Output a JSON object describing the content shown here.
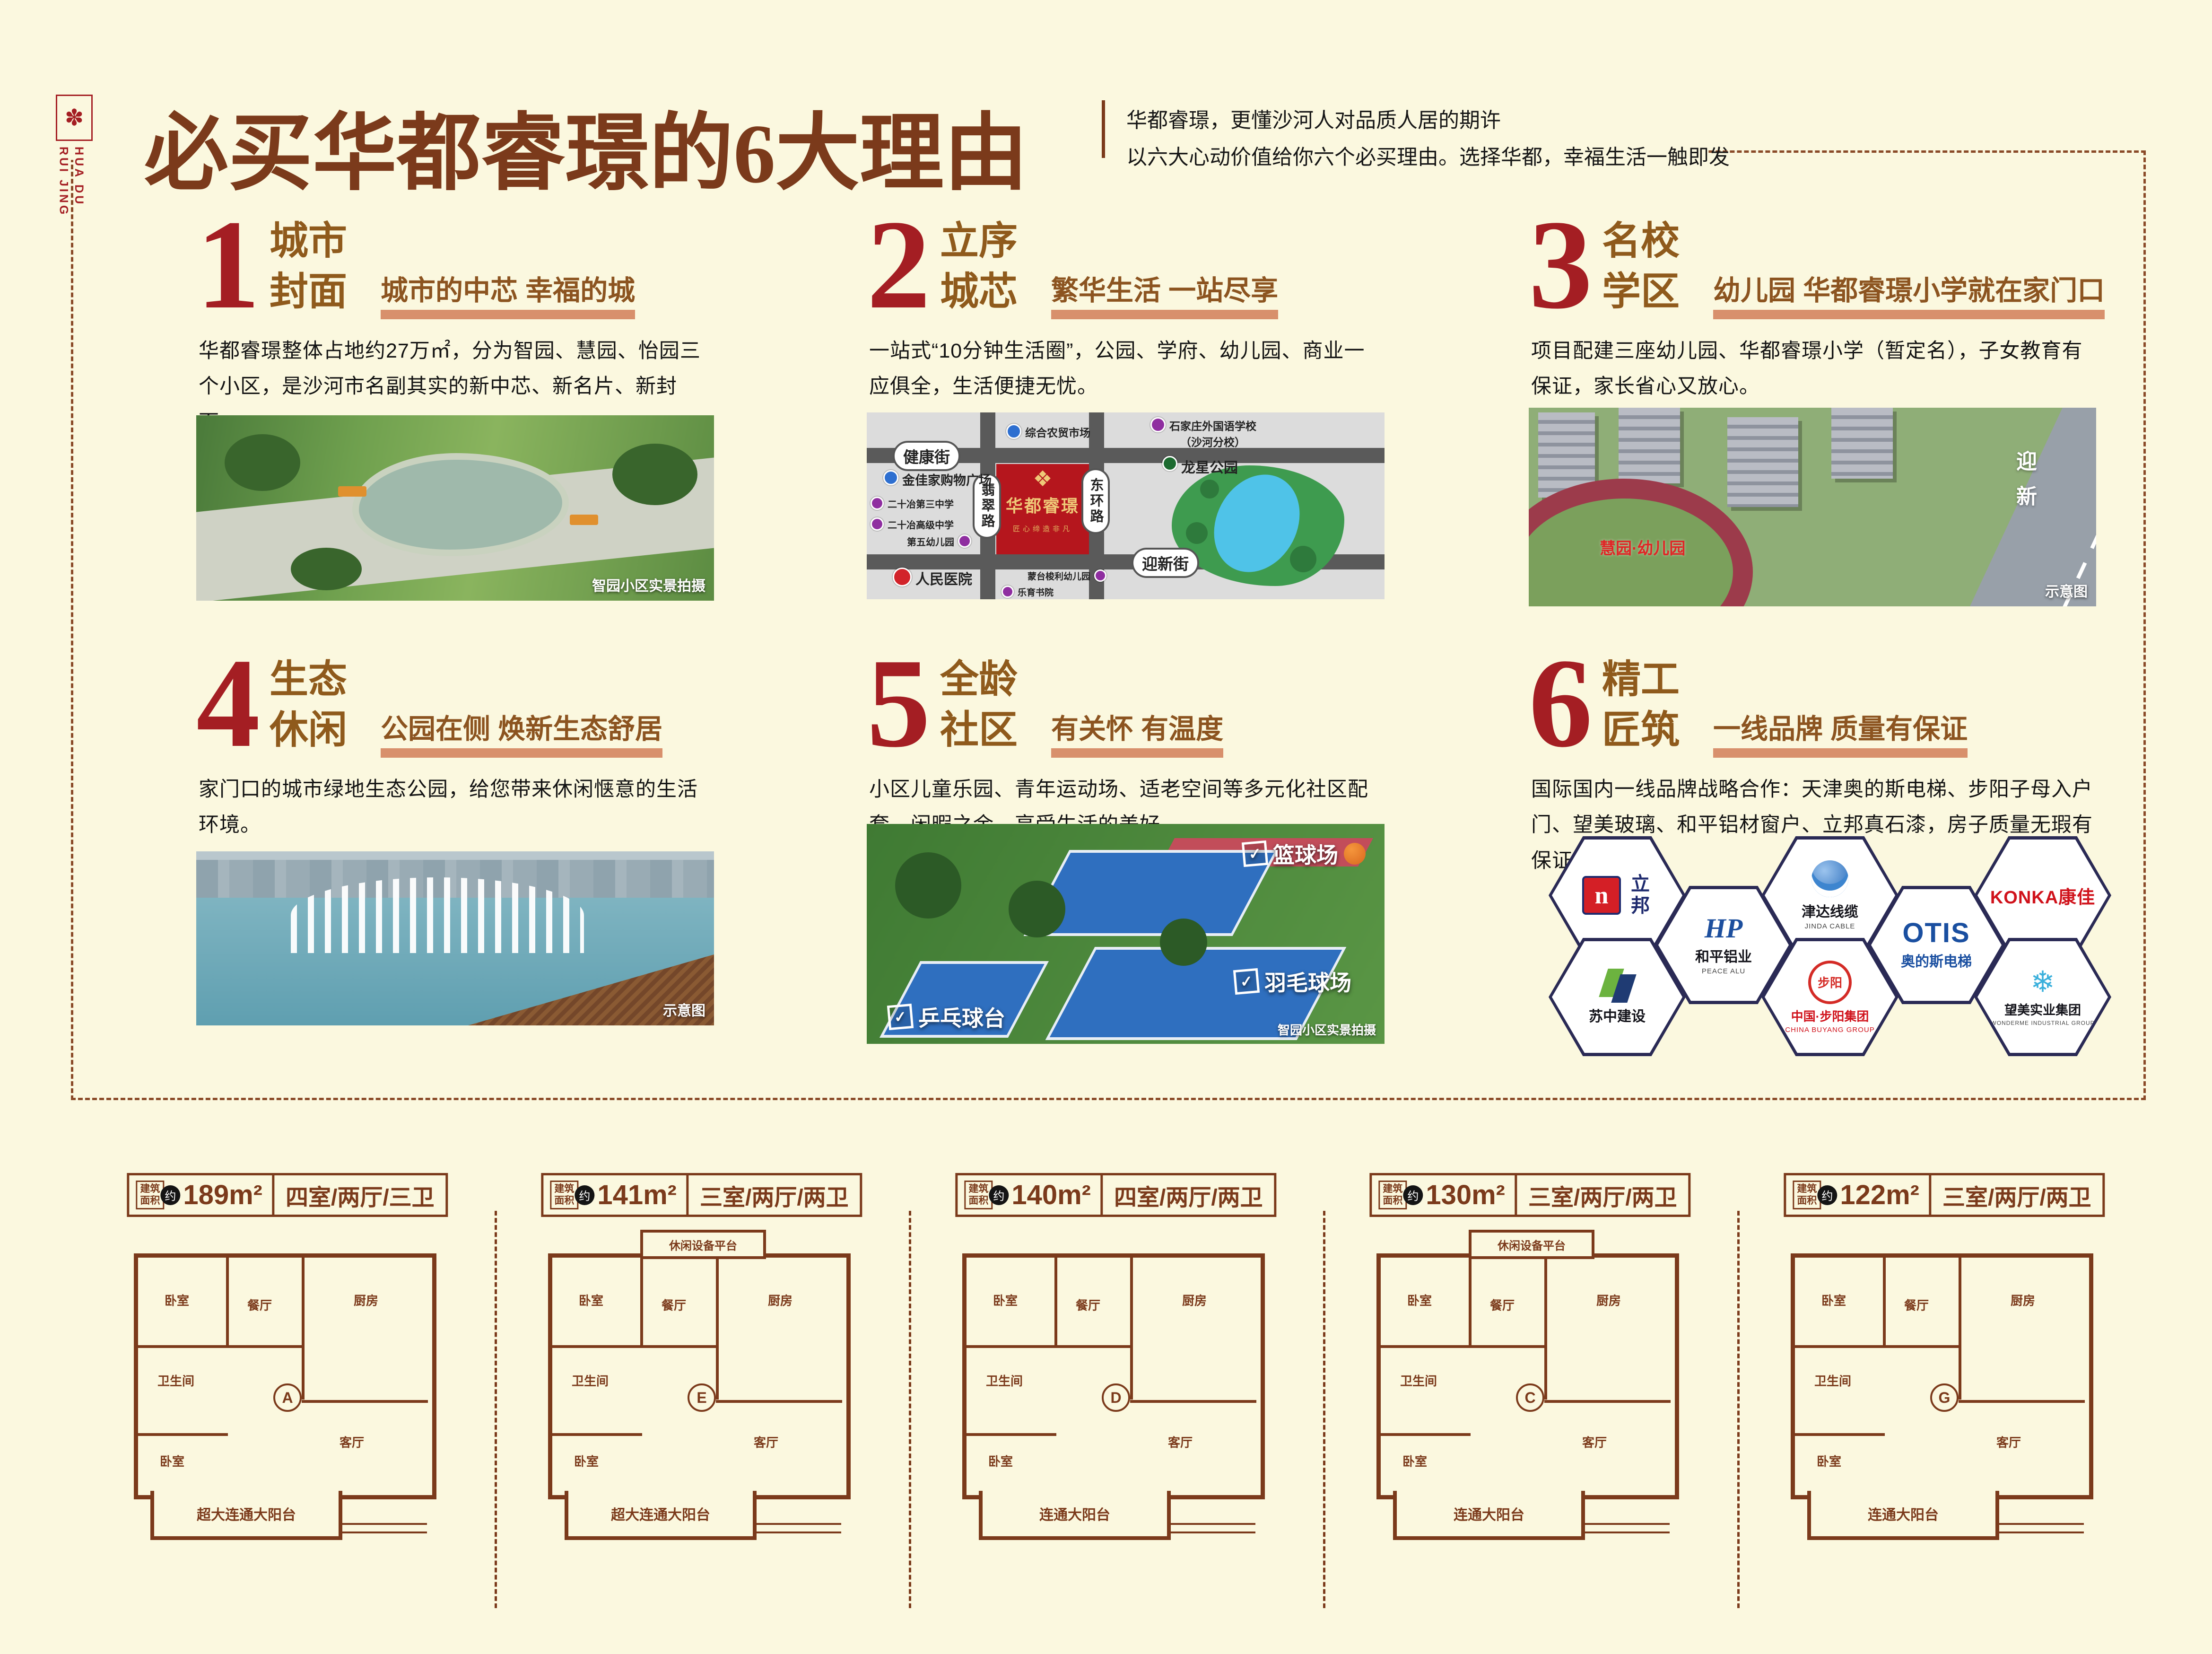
{
  "palette": {
    "background": "#FBF8DF",
    "title_brown": "#7B3A1B",
    "number_red": "#A41E23",
    "heading_tan": "#8F5A1C",
    "underline_salmon": "#D8906C",
    "map_project_red": "#B5161D",
    "map_gold": "#EFC978"
  },
  "logo": {
    "vertical_text": "HUA DU\nRUI JING"
  },
  "header": {
    "title": "必买华都睿璟的6大理由",
    "subtitle_line1": "华都睿璟，更懂沙河人对品质人居的期许",
    "subtitle_line2": "以六大心动价值给你六个必买理由。选择华都，幸福生活一触即发"
  },
  "sections": [
    {
      "number": "1",
      "title_line1": "城市",
      "title_line2": "封面",
      "tagline": "城市的中芯 幸福的城",
      "body": "华都睿璟整体占地约27万㎡，分为智园、慧园、怡园三个小区，是沙河市名副其实的新中芯、新名片、新封面。"
    },
    {
      "number": "2",
      "title_line1": "立序",
      "title_line2": "城芯",
      "tagline": "繁华生活 一站尽享",
      "body": "一站式“10分钟生活圈”，公园、学府、幼儿园、商业一应俱全，生活便捷无忧。"
    },
    {
      "number": "3",
      "title_line1": "名校",
      "title_line2": "学区",
      "tagline": "幼儿园 华都睿璟小学就在家门口",
      "body": "项目配建三座幼儿园、华都睿璟小学（暂定名），子女教育有保证，家长省心又放心。"
    },
    {
      "number": "4",
      "title_line1": "生态",
      "title_line2": "休闲",
      "tagline": "公园在侧 焕新生态舒居",
      "body": "家门口的城市绿地生态公园，给您带来休闲惬意的生活环境。"
    },
    {
      "number": "5",
      "title_line1": "全龄",
      "title_line2": "社区",
      "tagline": "有关怀 有温度",
      "body": "小区儿童乐园、青年运动场、适老空间等多元化社区配套，闲暇之余，享受生活的美好。"
    },
    {
      "number": "6",
      "title_line1": "精工",
      "title_line2": "匠筑",
      "tagline": "一线品牌 质量有保证",
      "body": "国际国内一线品牌战略合作：天津奥的斯电梯、步阳子母入户门、望美玻璃、和平铝材窗户、立邦真石漆，房子质量无瑕有保证。"
    }
  ],
  "photos": {
    "s1_caption": "智园小区实景拍摄",
    "s3_caption": "示意图",
    "s3_overlay": "慧园·幼儿园",
    "s3_road_chars": "迎新",
    "s4_caption": "示意图",
    "s5_caption": "智园小区实景拍摄",
    "s5_labels": [
      "篮球场",
      "羽毛球场",
      "乒乓球台"
    ]
  },
  "map": {
    "streets": {
      "top": "健康街",
      "bottom": "迎新街",
      "left": "翡翠路",
      "right": "东环路"
    },
    "project": {
      "name": "华都睿璟",
      "slogan": "匠心缔造非凡"
    },
    "park_label": "龙星公园",
    "pois": {
      "market": "综合农贸市场",
      "school_foreign_line1": "石家庄外国语学校",
      "school_foreign_line2": "（沙河分校）",
      "mall": "金佳家购物广场",
      "school3": "二十冶第三中学",
      "school_senior": "二十冶高级中学",
      "kindergarten5": "第五幼儿园",
      "hospital": "人民医院",
      "montessori": "蒙台梭利幼儿园",
      "academy": "乐育书院"
    }
  },
  "brands": [
    {
      "name": "立邦",
      "sub": ""
    },
    {
      "name": "津达线缆",
      "sub": "JINDA CABLE"
    },
    {
      "name": "KONKA康佳",
      "sub": ""
    },
    {
      "name": "和平铝业",
      "sub": "PEACE ALU"
    },
    {
      "name": "OTIS",
      "sub": "奥的斯电梯"
    },
    {
      "name": "苏中建设",
      "sub": ""
    },
    {
      "name": "中国·步阳集团",
      "sub": "CHINA BUYANG GROUP"
    },
    {
      "name": "望美实业集团",
      "sub": "WONDERME INDUSTRIAL GROUP"
    }
  ],
  "floorplan_common": {
    "badge_line1": "建筑",
    "badge_line2": "面积",
    "approx": "约",
    "rooms": {
      "bed": "卧室",
      "living": "客厅",
      "dining": "餐厅",
      "kitchen": "厨房",
      "bath": "卫生间",
      "leisure": "休闲设备平台"
    }
  },
  "floorplans": [
    {
      "area": "189m²",
      "layout": "四室/两厅/三卫",
      "unit": "A",
      "balcony": "超大连通大阳台"
    },
    {
      "area": "141m²",
      "layout": "三室/两厅/两卫",
      "unit": "E",
      "balcony": "超大连通大阳台"
    },
    {
      "area": "140m²",
      "layout": "四室/两厅/两卫",
      "unit": "D",
      "balcony": "连通大阳台"
    },
    {
      "area": "130m²",
      "layout": "三室/两厅/两卫",
      "unit": "C",
      "balcony": "连通大阳台"
    },
    {
      "area": "122m²",
      "layout": "三室/两厅/两卫",
      "unit": "G",
      "balcony": "连通大阳台"
    }
  ]
}
